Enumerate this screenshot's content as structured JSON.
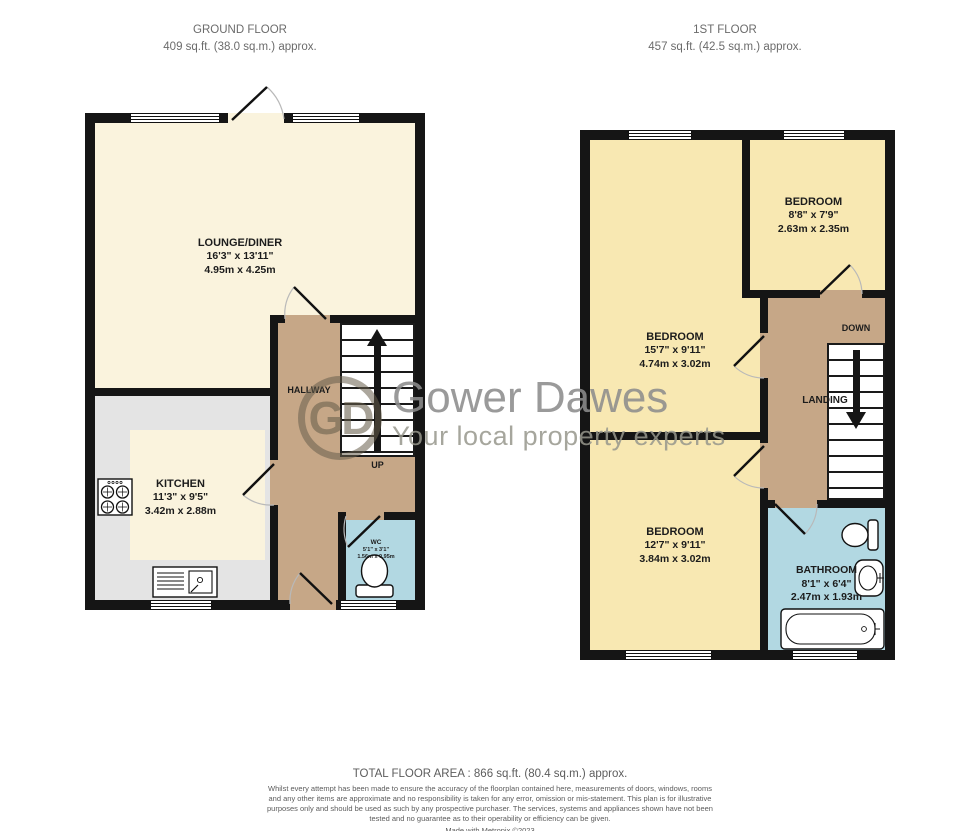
{
  "floors": {
    "ground": {
      "title": "GROUND FLOOR",
      "area": "409 sq.ft. (38.0 sq.m.) approx.",
      "rooms": {
        "lounge": {
          "name": "LOUNGE/DINER",
          "imperial": "16'3\" x 13'11\"",
          "metric": "4.95m x 4.25m"
        },
        "kitchen": {
          "name": "KITCHEN",
          "imperial": "11'3\" x 9'5\"",
          "metric": "3.42m x 2.88m"
        },
        "hallway": {
          "name": "HALLWAY"
        },
        "wc": {
          "name": "WC",
          "imperial": "5'1\" x 3'1\"",
          "metric": "1.56m x 0.95m"
        }
      },
      "stairs_label": "UP"
    },
    "first": {
      "title": "1ST FLOOR",
      "area": "457 sq.ft. (42.5 sq.m.) approx.",
      "rooms": {
        "bedroom_front": {
          "name": "BEDROOM",
          "imperial": "15'7\" x 9'11\"",
          "metric": "4.74m x 3.02m"
        },
        "bedroom_small": {
          "name": "BEDROOM",
          "imperial": "8'8\" x 7'9\"",
          "metric": "2.63m x 2.35m"
        },
        "bedroom_back": {
          "name": "BEDROOM",
          "imperial": "12'7\" x 9'11\"",
          "metric": "3.84m x 3.02m"
        },
        "bathroom": {
          "name": "BATHROOM",
          "imperial": "8'1\" x 6'4\"",
          "metric": "2.47m x 1.93m"
        },
        "landing": {
          "name": "LANDING"
        }
      },
      "stairs_label": "DOWN"
    }
  },
  "watermark": {
    "initials": "GD",
    "brand": "Gower Dawes",
    "tagline": "Your local property experts"
  },
  "footer": {
    "total_area": "TOTAL FLOOR AREA : 866 sq.ft. (80.4 sq.m.) approx.",
    "disclaimer": "Whilst every attempt has been made to ensure the accuracy of the floorplan contained here, measurements of doors, windows, rooms and any other items are approximate and no responsibility is taken for any error, omission or mis-statement. This plan is for illustrative purposes only and should be used as such by any prospective purchaser. The services, systems and appliances shown have not been tested and no guarantee as to their operability or efficiency can be given.",
    "credit": "Made with Metropix ©2023"
  },
  "colors": {
    "room_cream": "#FAF3DD",
    "room_yellow": "#F8E8B2",
    "hall_tan": "#C6A787",
    "wet_blue": "#B2D8E2",
    "kitchen_grey": "#E4E4E4",
    "wall": "#151515"
  }
}
